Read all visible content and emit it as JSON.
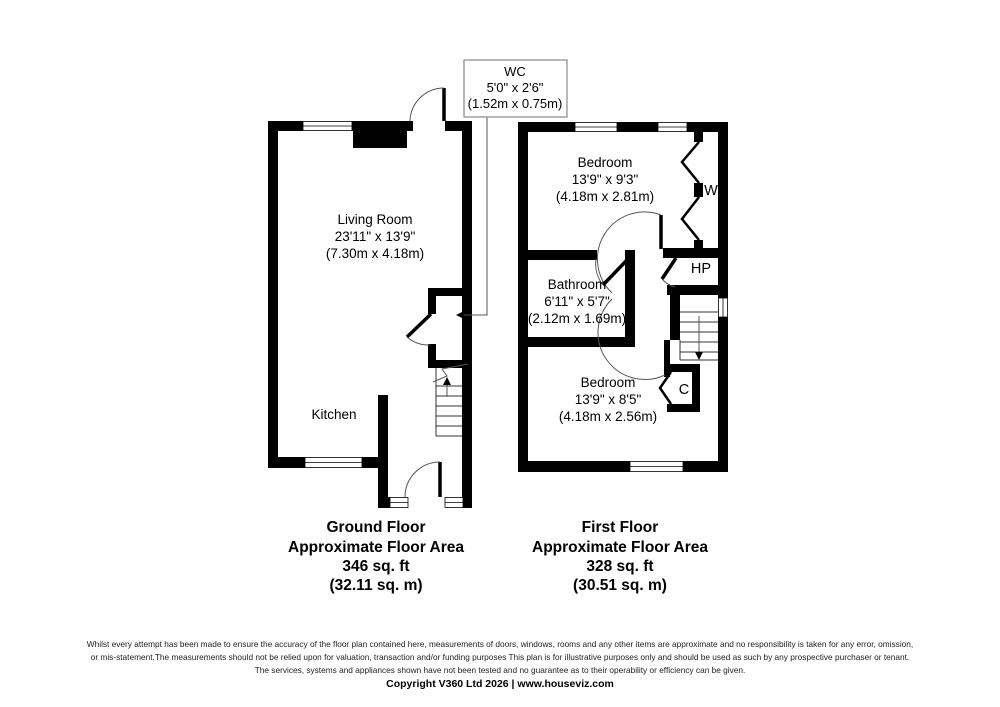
{
  "wc_callout": {
    "name": "WC",
    "dim_ft": "5'0\" x 2'6\"",
    "dim_m": "(1.52m x 0.75m)"
  },
  "ground": {
    "living": {
      "name": "Living Room",
      "dim_ft": "23'11\" x 13'9\"",
      "dim_m": "(7.30m x 4.18m)"
    },
    "kitchen": {
      "name": "Kitchen"
    },
    "title": "Ground Floor",
    "subtitle": "Approximate Floor Area",
    "area_ft": "346 sq. ft",
    "area_m": "(32.11 sq. m)"
  },
  "first": {
    "bedroom1": {
      "name": "Bedroom",
      "dim_ft": "13'9\" x 9'3\"",
      "dim_m": "(4.18m x 2.81m)"
    },
    "bathroom": {
      "name": "Bathroom",
      "dim_ft": "6'11\" x 5'7\"",
      "dim_m": "(2.12m x 1.69m)"
    },
    "bedroom2": {
      "name": "Bedroom",
      "dim_ft": "13'9\" x 8'5\"",
      "dim_m": "(4.18m x 2.56m)"
    },
    "wardrobe_label": "W",
    "hp_label": "HP",
    "closet_label": "C",
    "title": "First Floor",
    "subtitle": "Approximate Floor Area",
    "area_ft": "328 sq. ft",
    "area_m": "(30.51 sq. m)"
  },
  "footer": {
    "line1": "Whilst every attempt has been made to ensure the accuracy of the floor plan contained here, measurements of doors, windows, rooms and any other items are approximate and no responsibility is taken for any error, omission,",
    "line2": "or mis-statement.The measurements should not be relied upon for valuation, transaction and/or funding purposes This plan is for illustrative purposes only and should be used as such by any prospective purchaser or tenant.",
    "line3": "The services, systems and appliances shown have not been tested and no guarantee as to their operability or efficiency can be given.",
    "copyright": "Copyright V360 Ltd 2026 | www.houseviz.com"
  },
  "colors": {
    "wall": "#000000",
    "thin_line": "#555555",
    "callout_border": "#9a9a9a"
  }
}
